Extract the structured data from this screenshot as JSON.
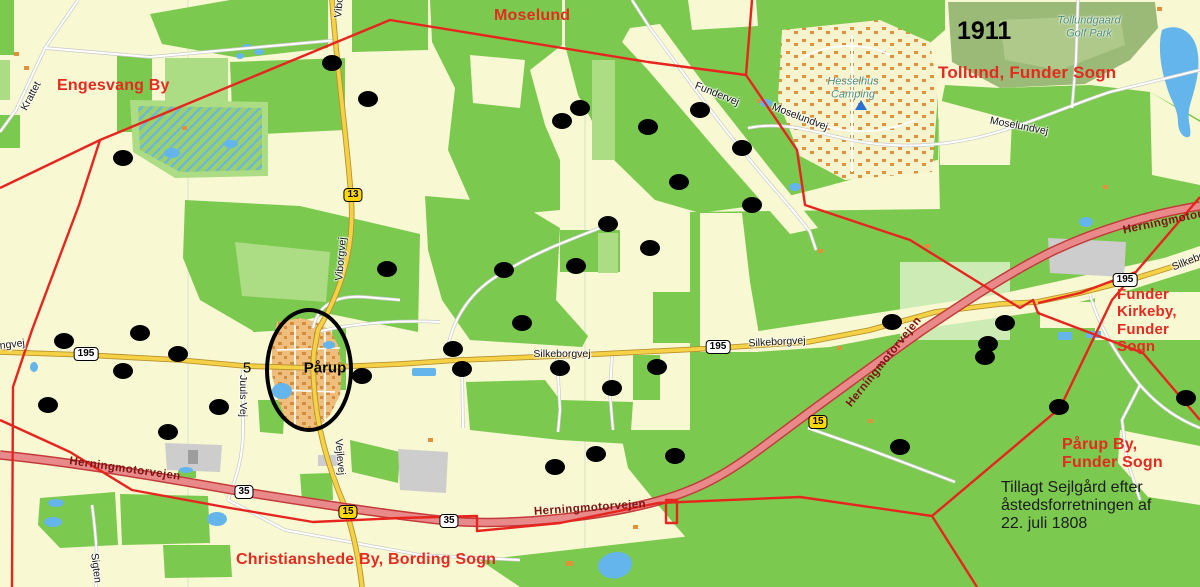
{
  "map": {
    "year": "1911",
    "note": {
      "lines": [
        "Tillagt Sejlgård efter",
        "åstedsforretningen af",
        "22. juli 1808"
      ],
      "x": 1001,
      "y": 479,
      "size": 16
    },
    "colors": {
      "area_label_red": "#e52a20",
      "boundary_red": "#e6251f",
      "motorway_fill": "#e98a8a",
      "motorway_casing": "#c43b3b",
      "road_yellow": "#f5d245",
      "forest_green": "#7cc94f",
      "water_blue": "#64b5ec",
      "place_label_teal": "#4f8f78"
    },
    "area_labels": [
      {
        "id": "engesvang-by",
        "lines": [
          "Engesvang By"
        ],
        "x": 57,
        "y": 77,
        "size": 16
      },
      {
        "id": "moselund",
        "lines": [
          "Moselund"
        ],
        "x": 494,
        "y": 7,
        "size": 16
      },
      {
        "id": "tollund-funder-sogn",
        "lines": [
          "Tollund, Funder Sogn"
        ],
        "x": 938,
        "y": 63,
        "size": 17
      },
      {
        "id": "funder-kirkeby-funder-sogn",
        "lines": [
          "Funder",
          "Kirkeby,",
          "Funder",
          "Sogn"
        ],
        "x": 1117,
        "y": 286,
        "size": 15
      },
      {
        "id": "paarup-by-funder-sogn",
        "lines": [
          "Pårup By,",
          "Funder Sogn"
        ],
        "x": 1062,
        "y": 436,
        "size": 16
      },
      {
        "id": "christianshede-by-bording-sogn",
        "lines": [
          "Christianshede By, Bording Sogn"
        ],
        "x": 236,
        "y": 551,
        "size": 16
      }
    ],
    "black_labels": [
      {
        "id": "paarup-town",
        "text": "Pårup",
        "cx": 325,
        "cy": 368,
        "size": 15,
        "bold": true
      },
      {
        "id": "number-five",
        "text": "5",
        "cx": 247,
        "cy": 368,
        "size": 15,
        "bold": false
      }
    ],
    "place_labels": [
      {
        "id": "hesselhus-camping",
        "lines": [
          "Hesselhus",
          "Camping"
        ],
        "cx": 853,
        "cy": 88
      },
      {
        "id": "tollundgaard-golf-park",
        "lines": [
          "Tollundgaard",
          "Golf Park"
        ],
        "cx": 1089,
        "cy": 27
      }
    ],
    "street_labels": [
      {
        "text": "Krattet",
        "cx": 31,
        "cy": 96,
        "rot": -62
      },
      {
        "text": "Engesvangvej",
        "cx": -8,
        "cy": 347,
        "rot": -7
      },
      {
        "text": "Viborgvej",
        "cx": 340,
        "cy": -4,
        "rot": -85
      },
      {
        "text": "Viborgvej",
        "cx": 341,
        "cy": 259,
        "rot": -85
      },
      {
        "text": "Juuls Vej",
        "cx": 243,
        "cy": 396,
        "rot": 90
      },
      {
        "text": "Vejlevej",
        "cx": 340,
        "cy": 457,
        "rot": 85
      },
      {
        "text": "Sigten",
        "cx": 96,
        "cy": 568,
        "rot": 83
      },
      {
        "text": "Fundervej",
        "cx": 717,
        "cy": 94,
        "rot": 22
      },
      {
        "text": "Moselundvej",
        "cx": 800,
        "cy": 117,
        "rot": 21
      },
      {
        "text": "Moselundvej",
        "cx": 1019,
        "cy": 126,
        "rot": 11
      },
      {
        "text": "Silkeborgvej",
        "cx": 562,
        "cy": 354,
        "rot": 0
      },
      {
        "text": "Silkeborgvej",
        "cx": 777,
        "cy": 342,
        "rot": -3
      },
      {
        "text": "Silkeborgvej",
        "cx": 1199,
        "cy": 257,
        "rot": -22
      }
    ],
    "motorway_labels": [
      {
        "text": "Herningmotorvejen",
        "cx": 125,
        "cy": 469,
        "rot": 8
      },
      {
        "text": "Herningmotorvejen",
        "cx": 590,
        "cy": 508,
        "rot": -4
      },
      {
        "text": "Herningmotorvejen",
        "cx": 884,
        "cy": 362,
        "rot": -51
      },
      {
        "text": "Herningmotorvejen",
        "cx": 1178,
        "cy": 219,
        "rot": -12
      }
    ],
    "shields": [
      {
        "text": "13",
        "style": "yellow",
        "cx": 353,
        "cy": 195
      },
      {
        "text": "195",
        "style": "white",
        "cx": 86,
        "cy": 354
      },
      {
        "text": "195",
        "style": "white",
        "cx": 718,
        "cy": 347
      },
      {
        "text": "195",
        "style": "white",
        "cx": 1125,
        "cy": 280
      },
      {
        "text": "35",
        "style": "white",
        "cx": 244,
        "cy": 492
      },
      {
        "text": "35",
        "style": "white",
        "cx": 449,
        "cy": 521
      },
      {
        "text": "15",
        "style": "yellow",
        "cx": 348,
        "cy": 512
      },
      {
        "text": "15",
        "style": "yellow",
        "cx": 818,
        "cy": 422
      }
    ],
    "icons": [
      {
        "name": "campground-icon",
        "cx": 861,
        "cy": 105
      }
    ],
    "annotation_ellipse": {
      "cx": 309,
      "cy": 370,
      "rx": 40,
      "ry": 58
    },
    "dots": [
      [
        332,
        63
      ],
      [
        368,
        99
      ],
      [
        123,
        158
      ],
      [
        580,
        108
      ],
      [
        562,
        121
      ],
      [
        648,
        127
      ],
      [
        700,
        110
      ],
      [
        742,
        148
      ],
      [
        679,
        182
      ],
      [
        752,
        205
      ],
      [
        608,
        224
      ],
      [
        650,
        248
      ],
      [
        576,
        266
      ],
      [
        504,
        270
      ],
      [
        387,
        269
      ],
      [
        522,
        323
      ],
      [
        453,
        349
      ],
      [
        462,
        369
      ],
      [
        560,
        368
      ],
      [
        612,
        388
      ],
      [
        657,
        367
      ],
      [
        64,
        341
      ],
      [
        140,
        333
      ],
      [
        123,
        371
      ],
      [
        178,
        354
      ],
      [
        362,
        376
      ],
      [
        48,
        405
      ],
      [
        219,
        407
      ],
      [
        168,
        432
      ],
      [
        555,
        467
      ],
      [
        596,
        454
      ],
      [
        675,
        456
      ],
      [
        892,
        322
      ],
      [
        1005,
        323
      ],
      [
        988,
        344
      ],
      [
        985,
        357
      ],
      [
        900,
        447
      ],
      [
        1059,
        407
      ],
      [
        1186,
        398
      ]
    ]
  }
}
